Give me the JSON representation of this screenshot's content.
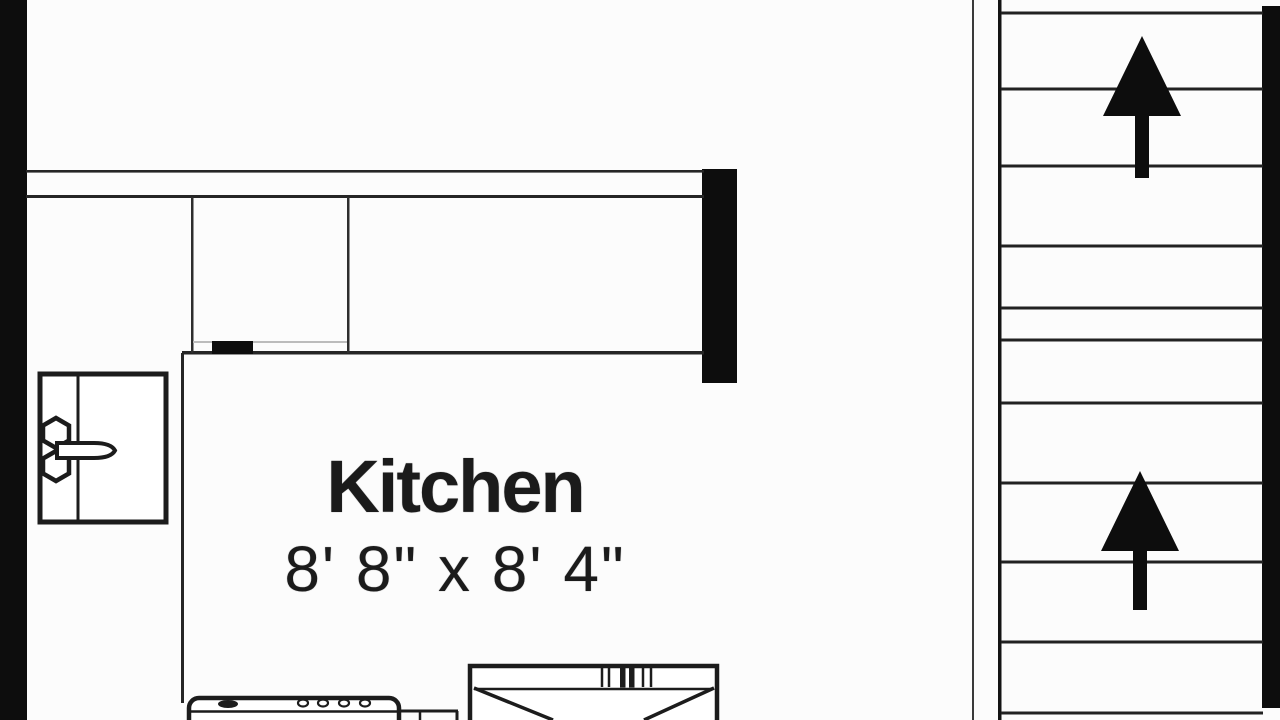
{
  "room": {
    "name": "Kitchen",
    "dimensions": "8' 8\" x 8' 4\""
  },
  "stairs": {
    "direction": "up",
    "flights": 2,
    "tread_count": 11,
    "arrow_icon": "up-arrow"
  },
  "fixtures": {
    "left_fixture_icon": "utility-sink",
    "bottom_left_icon": "range-stove",
    "bottom_center_icon": "double-basin-sink",
    "cabinet_handle_icon": "cabinet-handle"
  },
  "colors": {
    "wall": "#0d0d0d",
    "line": "#262626",
    "faint_line": "#bcbcbc",
    "background": "#fcfcfc",
    "text": "#1b1b1b"
  }
}
